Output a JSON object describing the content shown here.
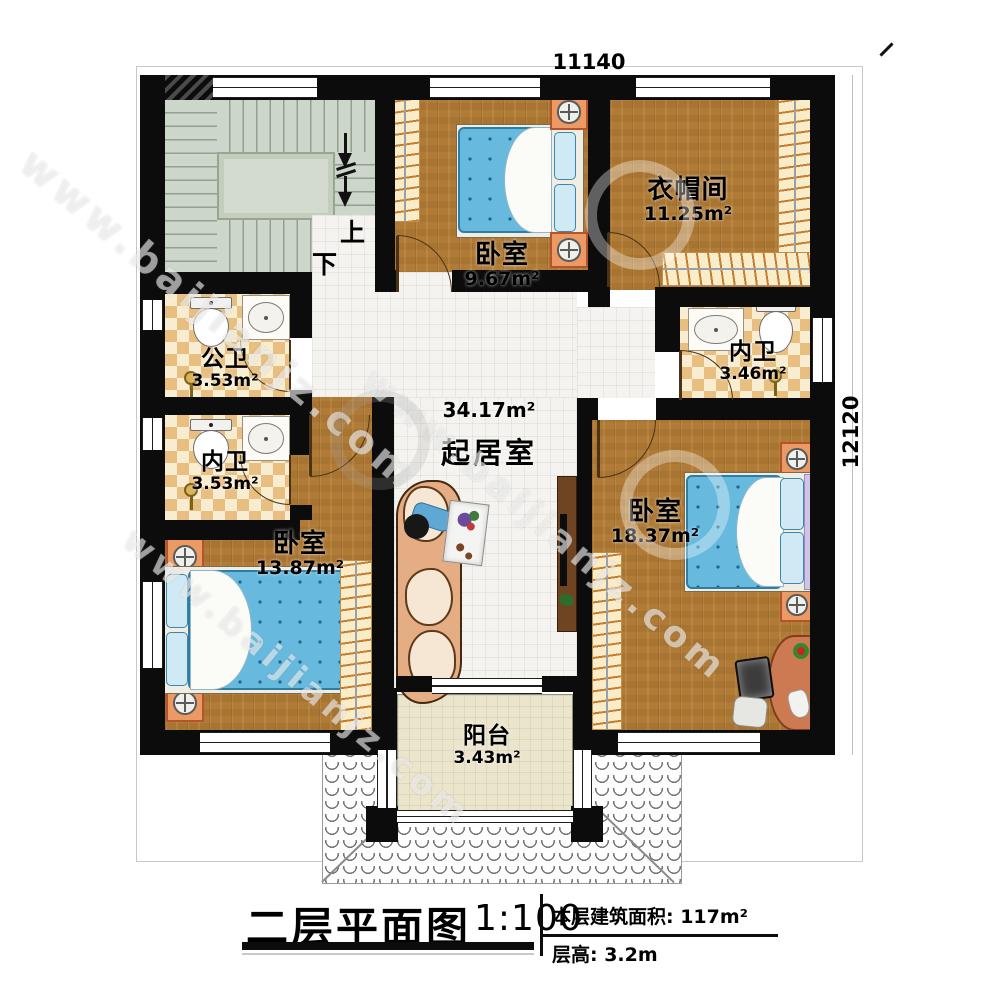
{
  "dimensions": {
    "top": "11140",
    "right": "12120"
  },
  "stairs": {
    "up_label": "上",
    "down_label": "下"
  },
  "rooms": [
    {
      "id": "bedroom-top",
      "name": "卧室",
      "area": "9.67m²"
    },
    {
      "id": "cloakroom",
      "name": "衣帽间",
      "area": "11.25m²"
    },
    {
      "id": "public-bathroom",
      "name": "公卫",
      "area": "3.53m²"
    },
    {
      "id": "ensuite-bath-right",
      "name": "内卫",
      "area": "3.46m²"
    },
    {
      "id": "ensuite-bath-left",
      "name": "内卫",
      "area": "3.53m²"
    },
    {
      "id": "living-room",
      "name": "起居室",
      "area": "34.17m²"
    },
    {
      "id": "bedroom-left",
      "name": "卧室",
      "area": "13.87m²"
    },
    {
      "id": "bedroom-right",
      "name": "卧室",
      "area": "18.37m²"
    },
    {
      "id": "balcony",
      "name": "阳台",
      "area": "3.43m²"
    }
  ],
  "title_block": {
    "title": "二层平面图",
    "scale": "1:100",
    "floor_area": "本层建筑面积: 117m²",
    "floor_height": "层高: 3.2m"
  },
  "watermark": {
    "url": "www.baijianjz.com"
  },
  "colors": {
    "wall": "#0c0c0c",
    "wood_floor": "#b07b36",
    "tile_floor": "#f4f3ef",
    "bath_checker_dark": "#e8bf81",
    "bath_checker_light": "#f8edd0",
    "stair_floor": "#cdd6ca",
    "balcony_floor": "#ebe5cc",
    "bed_mattress": "#67bade",
    "furniture_accent": "#ea9a62"
  }
}
